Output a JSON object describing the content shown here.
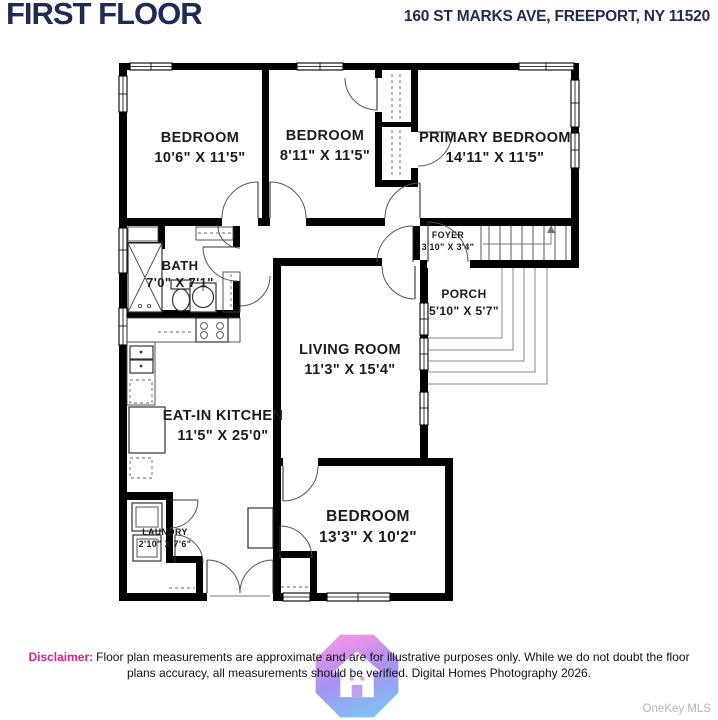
{
  "header": {
    "title": "FIRST FLOOR",
    "address": "160 ST MARKS AVE, FREEPORT, NY 11520"
  },
  "rooms": [
    {
      "name": "BEDROOM",
      "dims": "10'6\" X 11'5\""
    },
    {
      "name": "BEDROOM",
      "dims": "8'11\" X 11'5\""
    },
    {
      "name": "PRIMARY BEDROOM",
      "dims": "14'11\" X 11'5\""
    },
    {
      "name": "FOYER",
      "dims": "3'10\" X 3'4\""
    },
    {
      "name": "BATH",
      "dims": "7'0\" X 7'1\""
    },
    {
      "name": "PORCH",
      "dims": "5'10\" X 5'7\""
    },
    {
      "name": "LIVING ROOM",
      "dims": "11'3\" X 15'4\""
    },
    {
      "name": "EAT-IN KITCHEN",
      "dims": "11'5\" X 25'0\""
    },
    {
      "name": "LAUNDRY",
      "dims": "2'10\" X 7'6\""
    },
    {
      "name": "BEDROOM",
      "dims": "13'3\" X 10'2\""
    }
  ],
  "footer": {
    "disclaimer_label": "Disclaimer:",
    "disclaimer_text": "Floor plan measurements are approximate and are for illustrative purposes only. While we do not doubt the floor plans accuracy, all measurements should be verified. Digital Homes Photography 2026.",
    "mls": "OneKey MLS"
  },
  "colors": {
    "title_navy": "#1d2b56",
    "wall_black": "#000000",
    "disclaimer_pink": "#d6219c",
    "mls_gray": "#b5b5b5",
    "logo_pink": "#f07ae2",
    "logo_purple": "#9277f0",
    "logo_blue": "#5ab5ee"
  }
}
